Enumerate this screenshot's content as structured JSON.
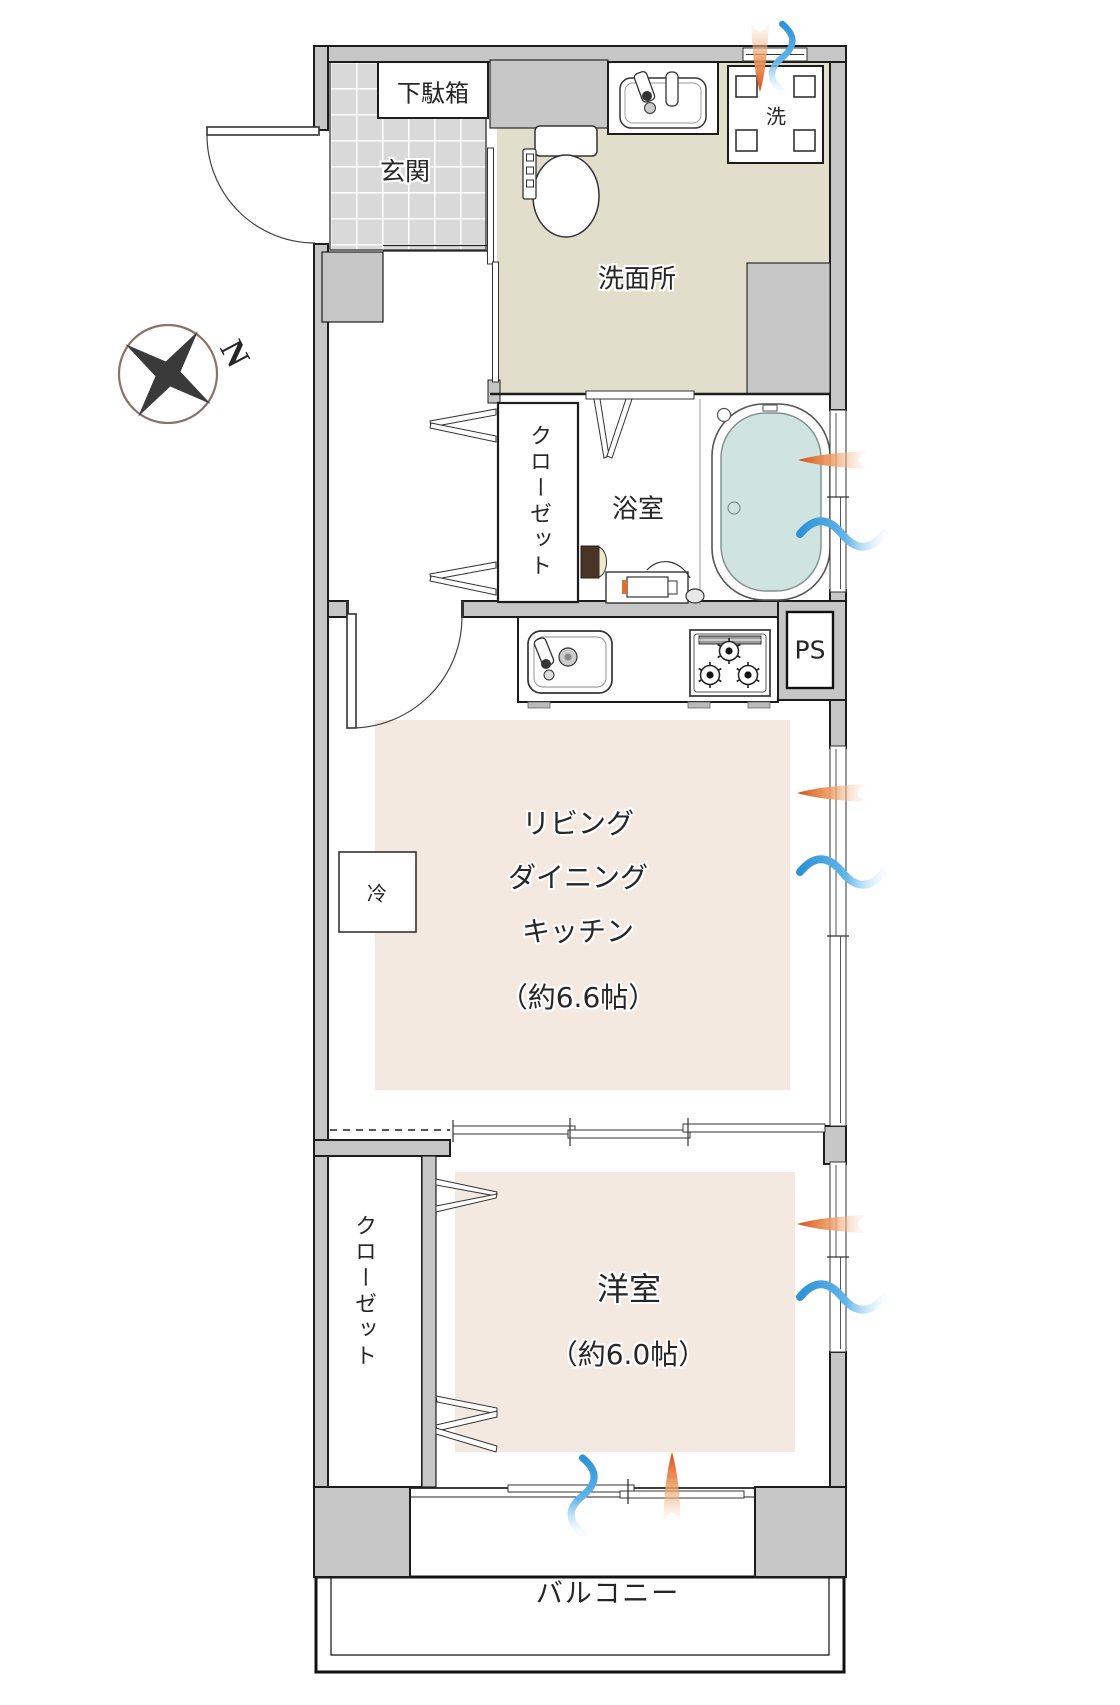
{
  "colors": {
    "wall": "#c6c6c6",
    "tile": "#d9d9d9",
    "washroom_floor": "#e1decb",
    "room_floor": "#f4e9e1",
    "tub_water": "#cfe3e1",
    "hot": "#dd5a1a",
    "cold": "#3d9bd6",
    "outline": "#1c1c1c"
  },
  "compass": {
    "north_label": "N"
  },
  "rooms": {
    "entrance": {
      "label": "玄関"
    },
    "shoe_cabinet": {
      "label": "下駄箱"
    },
    "washroom": {
      "label": "洗面所"
    },
    "washing_machine": {
      "label": "洗"
    },
    "hall_closet": {
      "label": "クローゼット"
    },
    "bathroom": {
      "label": "浴室"
    },
    "pipe_space": {
      "label": "PS"
    },
    "ldk": {
      "line1": "リビング",
      "line2": "ダイニング",
      "line3": "キッチン",
      "size": "（約6.6帖）"
    },
    "refrigerator": {
      "label": "冷"
    },
    "bedroom_closet": {
      "label": "クローゼット"
    },
    "bedroom": {
      "label": "洋室",
      "size": "（約6.0帖）"
    },
    "balcony": {
      "label": "バルコニー"
    }
  }
}
